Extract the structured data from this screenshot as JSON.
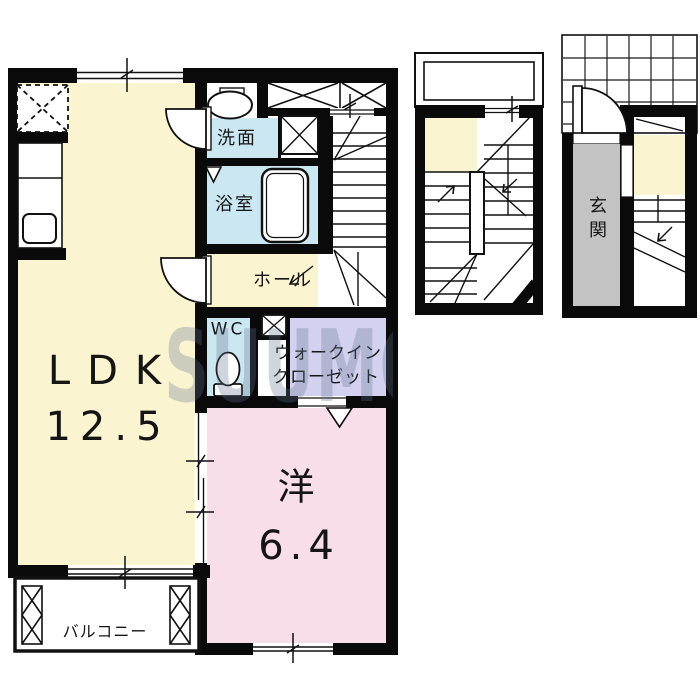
{
  "floorplan": {
    "watermark_text": "SUUMO",
    "second_floor": {
      "ldk": {
        "label": "LDK",
        "area": "12.5"
      },
      "western_room": {
        "label": "洋",
        "area": "6.4"
      },
      "washroom": {
        "label": "洗面"
      },
      "bathroom": {
        "label": "浴室"
      },
      "hall": {
        "label": "ホール"
      },
      "wc": {
        "label": "WC"
      },
      "walk_in_closet": {
        "label_line1": "ウォークイン",
        "label_line2": "クローゼット"
      },
      "balcony": {
        "label": "バルコニー"
      }
    },
    "first_floor": {
      "entrance": {
        "label": "玄関"
      }
    },
    "colors": {
      "room_yellow": "#FAF4D0",
      "water_blue": "#CBE7F2",
      "bedroom_pink": "#F8DEE8",
      "closet_lavender": "#D3D1EF",
      "entrance_gray": "#C3C3C3",
      "wall_black": "#0A0A0A",
      "watermark_gray": "rgba(100,116,142,0.30)"
    }
  }
}
